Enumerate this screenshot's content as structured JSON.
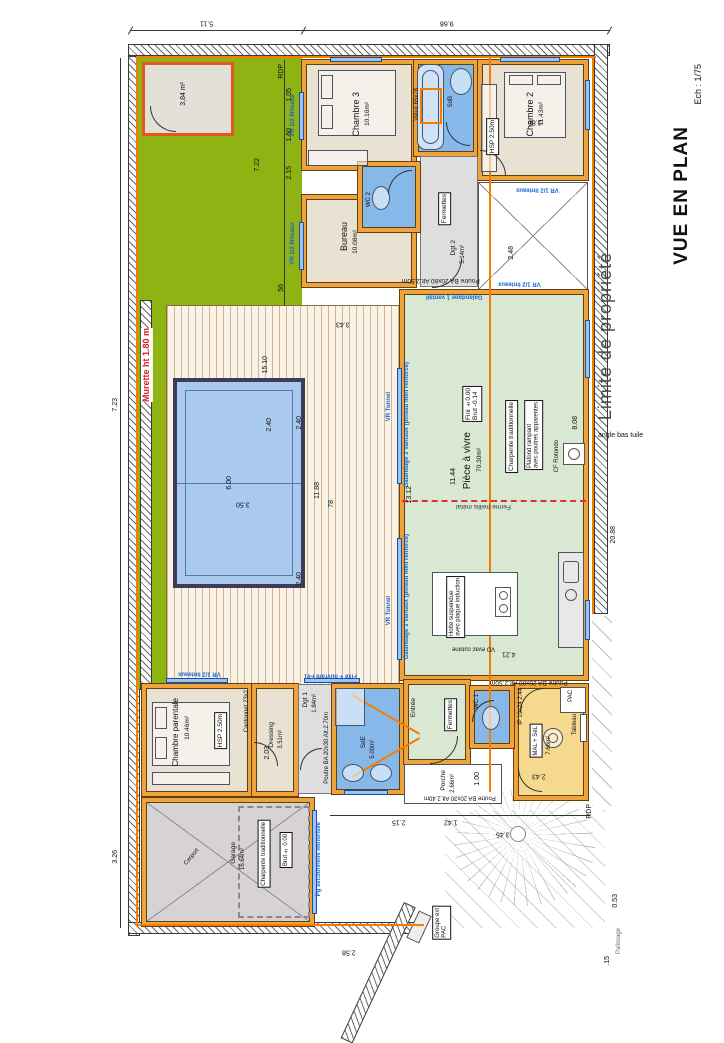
{
  "title": {
    "name": "VUE EN PLAN",
    "scale": "Ech : 1/75"
  },
  "site": {
    "limite": "Limite de propriété",
    "angle_bas_tuile": "angle bas tuile",
    "murette": "Murette ht 1.80 m",
    "rdp_top": "RDP",
    "rdp_bottom": "RDP",
    "palissage": "Palissage",
    "abri_area": "3,84 m²",
    "groupe1": "Groupe ext",
    "groupe2": "PAC"
  },
  "rooms": {
    "chambre3": {
      "name": "Chambre 3",
      "area": "10.16m²"
    },
    "sdb": {
      "name": "SdB",
      "velux": "Velux 65x78"
    },
    "chambre2": {
      "name": "Chambre 2",
      "area": "11.43m²",
      "hsp": "HSP 2.50m"
    },
    "bureau": {
      "name": "Bureau",
      "area": "10.08m²"
    },
    "wc2": {
      "name": "WC 2"
    },
    "dgt2": {
      "name": "Dgt 2",
      "area": "5.14m²",
      "fermettes": "Fermettes"
    },
    "piece_a_vivre": {
      "name": "Pièce à vivre",
      "area": "70.30m²",
      "fini": "Fini ±0.00",
      "brut": "Brut -0.14",
      "charpente": "Charpente traditionnelle",
      "plafond1": "Plafond rampant",
      "plafond2": "avec poutres apparentes",
      "poele": "CF Rotondo",
      "ferme": "Ferme treillis métal",
      "ilot1": "Hotte suspendue",
      "ilot2": "avec plaque induction",
      "evac": "VD évac cuisine"
    },
    "chambre_parentale": {
      "name": "Chambre parentale",
      "area": "10.46m²",
      "hsp": "HSP 2.50m",
      "cantonnet": "Cantonnet 23x2"
    },
    "dressing": {
      "name": "Dressing",
      "area": "3.51m²"
    },
    "dgt1": {
      "name": "Dgt 1",
      "area": "1.84m²"
    },
    "sde": {
      "name": "SdE",
      "area": "5.00m²"
    },
    "wc1": {
      "name": "WC 1"
    },
    "entree": {
      "name": "Entrée",
      "fermettes": "Fermettes"
    },
    "porche": {
      "name": "Porche",
      "area": "2.66m²"
    },
    "cellier": {
      "name": "Cellier",
      "area": "7.66m²",
      "pac": "PAC",
      "tableau": "Tableau",
      "mal": "MAL + SèL",
      "ip": "IP 19x24 2.44"
    },
    "garage": {
      "name": "Garage",
      "area": "16.64m²",
      "charpente": "Charpente traditionnelle",
      "brut": "Brut ± 0.00",
      "carport": "Carport"
    }
  },
  "openings": {
    "vr12_a": "VR 1/2 linteaux",
    "vr12_b": "VR 1/2 linteaux",
    "vr12_c": "VR 1/2 linteaux",
    "vr12_d": "VR 1/2 linteaux",
    "vr12_e": "VR 1/2 linteaux",
    "vr_tunnel_a": "VR Tunnel",
    "vr_tunnel_b": "VR Tunnel",
    "galandage3_a": "Galandage 3 Vantaux (poteau mini renforcé)",
    "galandage3_b": "Galandage 3 Vantaux (poteau mini renforcé)",
    "galandage1": "Galandage 1 vantail",
    "pg": "Pg sectionnelle motorisée",
    "fixe": "Fixe + ouvrant Fe1"
  },
  "beams": {
    "poutre_n": "Poutre BA 20x80 Alt.2.50m",
    "poutre_s": "Poutre BA 20x80 Alt.2.50m",
    "poutre_ch": "Poutre BA 20x30 Alt.2.70m",
    "poutre_porche": "Poutre BA 20x30 Alt.2.40m"
  },
  "dims": {
    "d1": "5.11",
    "d2": "9.68",
    "d3": "7.23",
    "d4": "3.26",
    "d5": "7.22",
    "d6": "2.40",
    "d7": "1.05",
    "d8": "1.60",
    "d9": "2.15",
    "d13": "56",
    "d14": "15.10",
    "d15": "11.88",
    "d16": "6.00",
    "d17": "3.50",
    "d18": "2.40",
    "d19": "2.40",
    "d20": "78",
    "d21": "13.12",
    "d22": "11.44",
    "d23": "4.21",
    "d24": "3.43",
    "d25": "8.08",
    "d26": "20.88",
    "d27": "0.53",
    "d28": ".15",
    "d29": "2.48",
    "d30": "3.86",
    "d31": "2.15",
    "d32": "1.42",
    "d33": "3.45",
    "d34": "2.03",
    "d35": "1.00",
    "d36": "2.43",
    "d37": "2.58"
  }
}
